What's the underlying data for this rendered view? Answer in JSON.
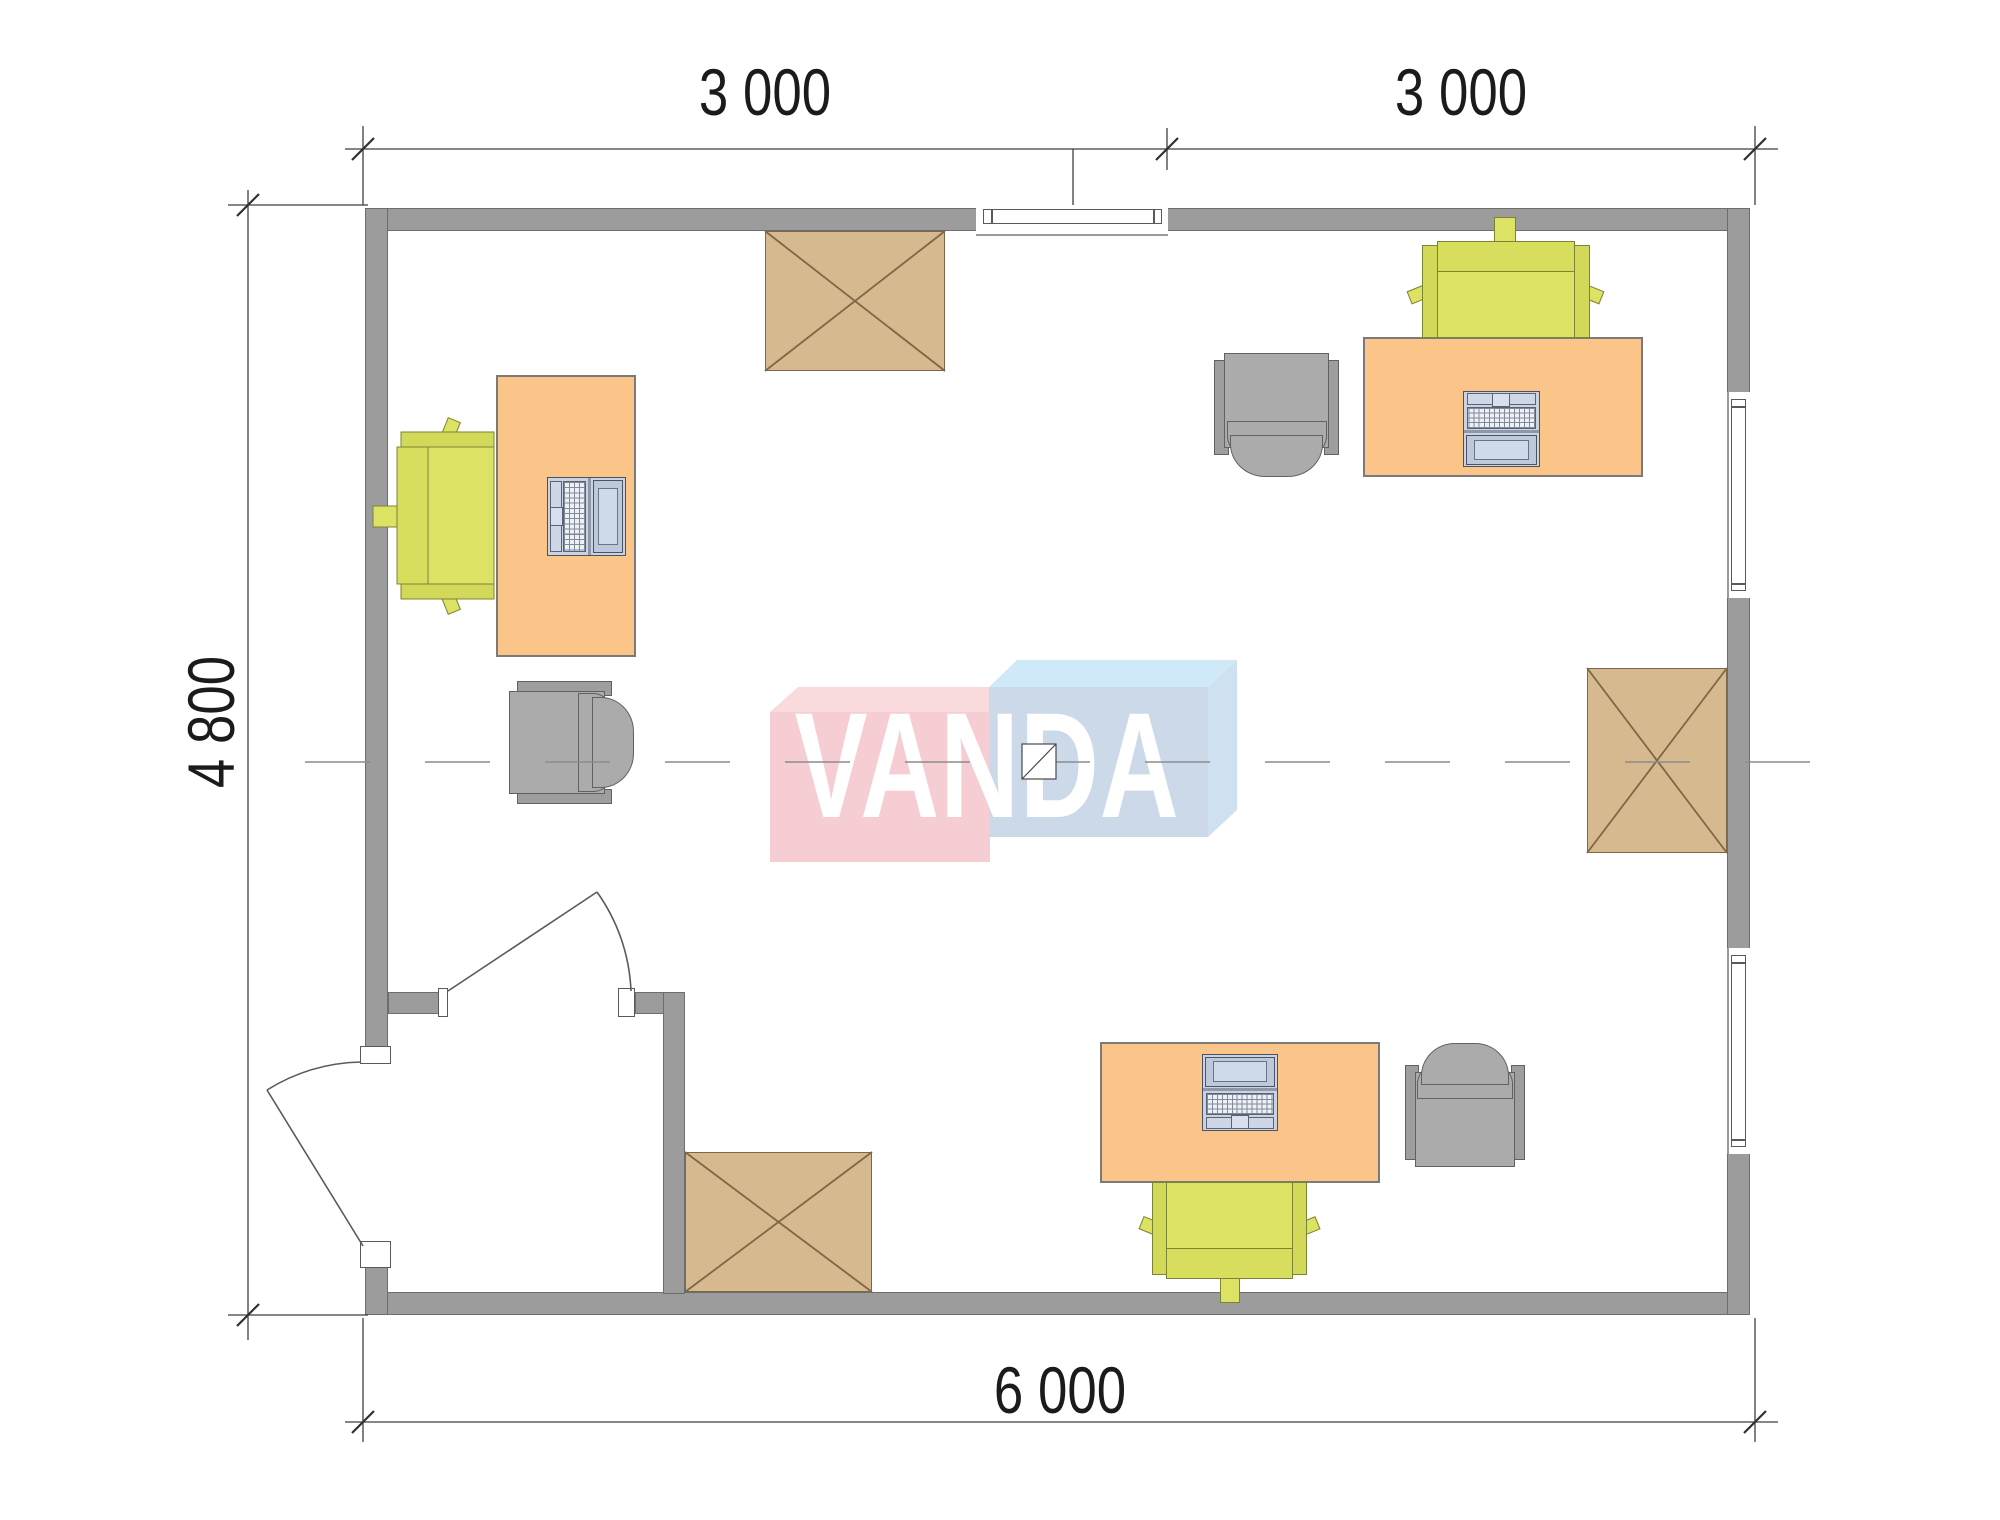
{
  "drawing": {
    "type": "office floor plan",
    "dimensions": {
      "top_left": "3 000",
      "top_right": "3 000",
      "left": "4 800",
      "bottom": "6 000"
    },
    "logo": {
      "text": "VANDA"
    },
    "colors": {
      "wall": "#9c9c9c",
      "desk": "#fbc488",
      "crossed_table": "#d6b98f",
      "task_chair": "#dce264",
      "armchair": "#ababab",
      "laptop": "#c9d3e1",
      "logo_pink_front": "#f6cdd3",
      "logo_pink_top": "#f9dadd",
      "logo_blue_front": "#cbd9e8",
      "logo_blue_top": "#cfe9f8",
      "dimension_line": "#3f3f3f",
      "centerline": "#8c8c8c"
    },
    "inventory": {
      "desks": 3,
      "laptops": 3,
      "task_chairs": 3,
      "armchairs": 3,
      "crossed_tables": 3,
      "windows": 3,
      "doors": 2
    }
  }
}
